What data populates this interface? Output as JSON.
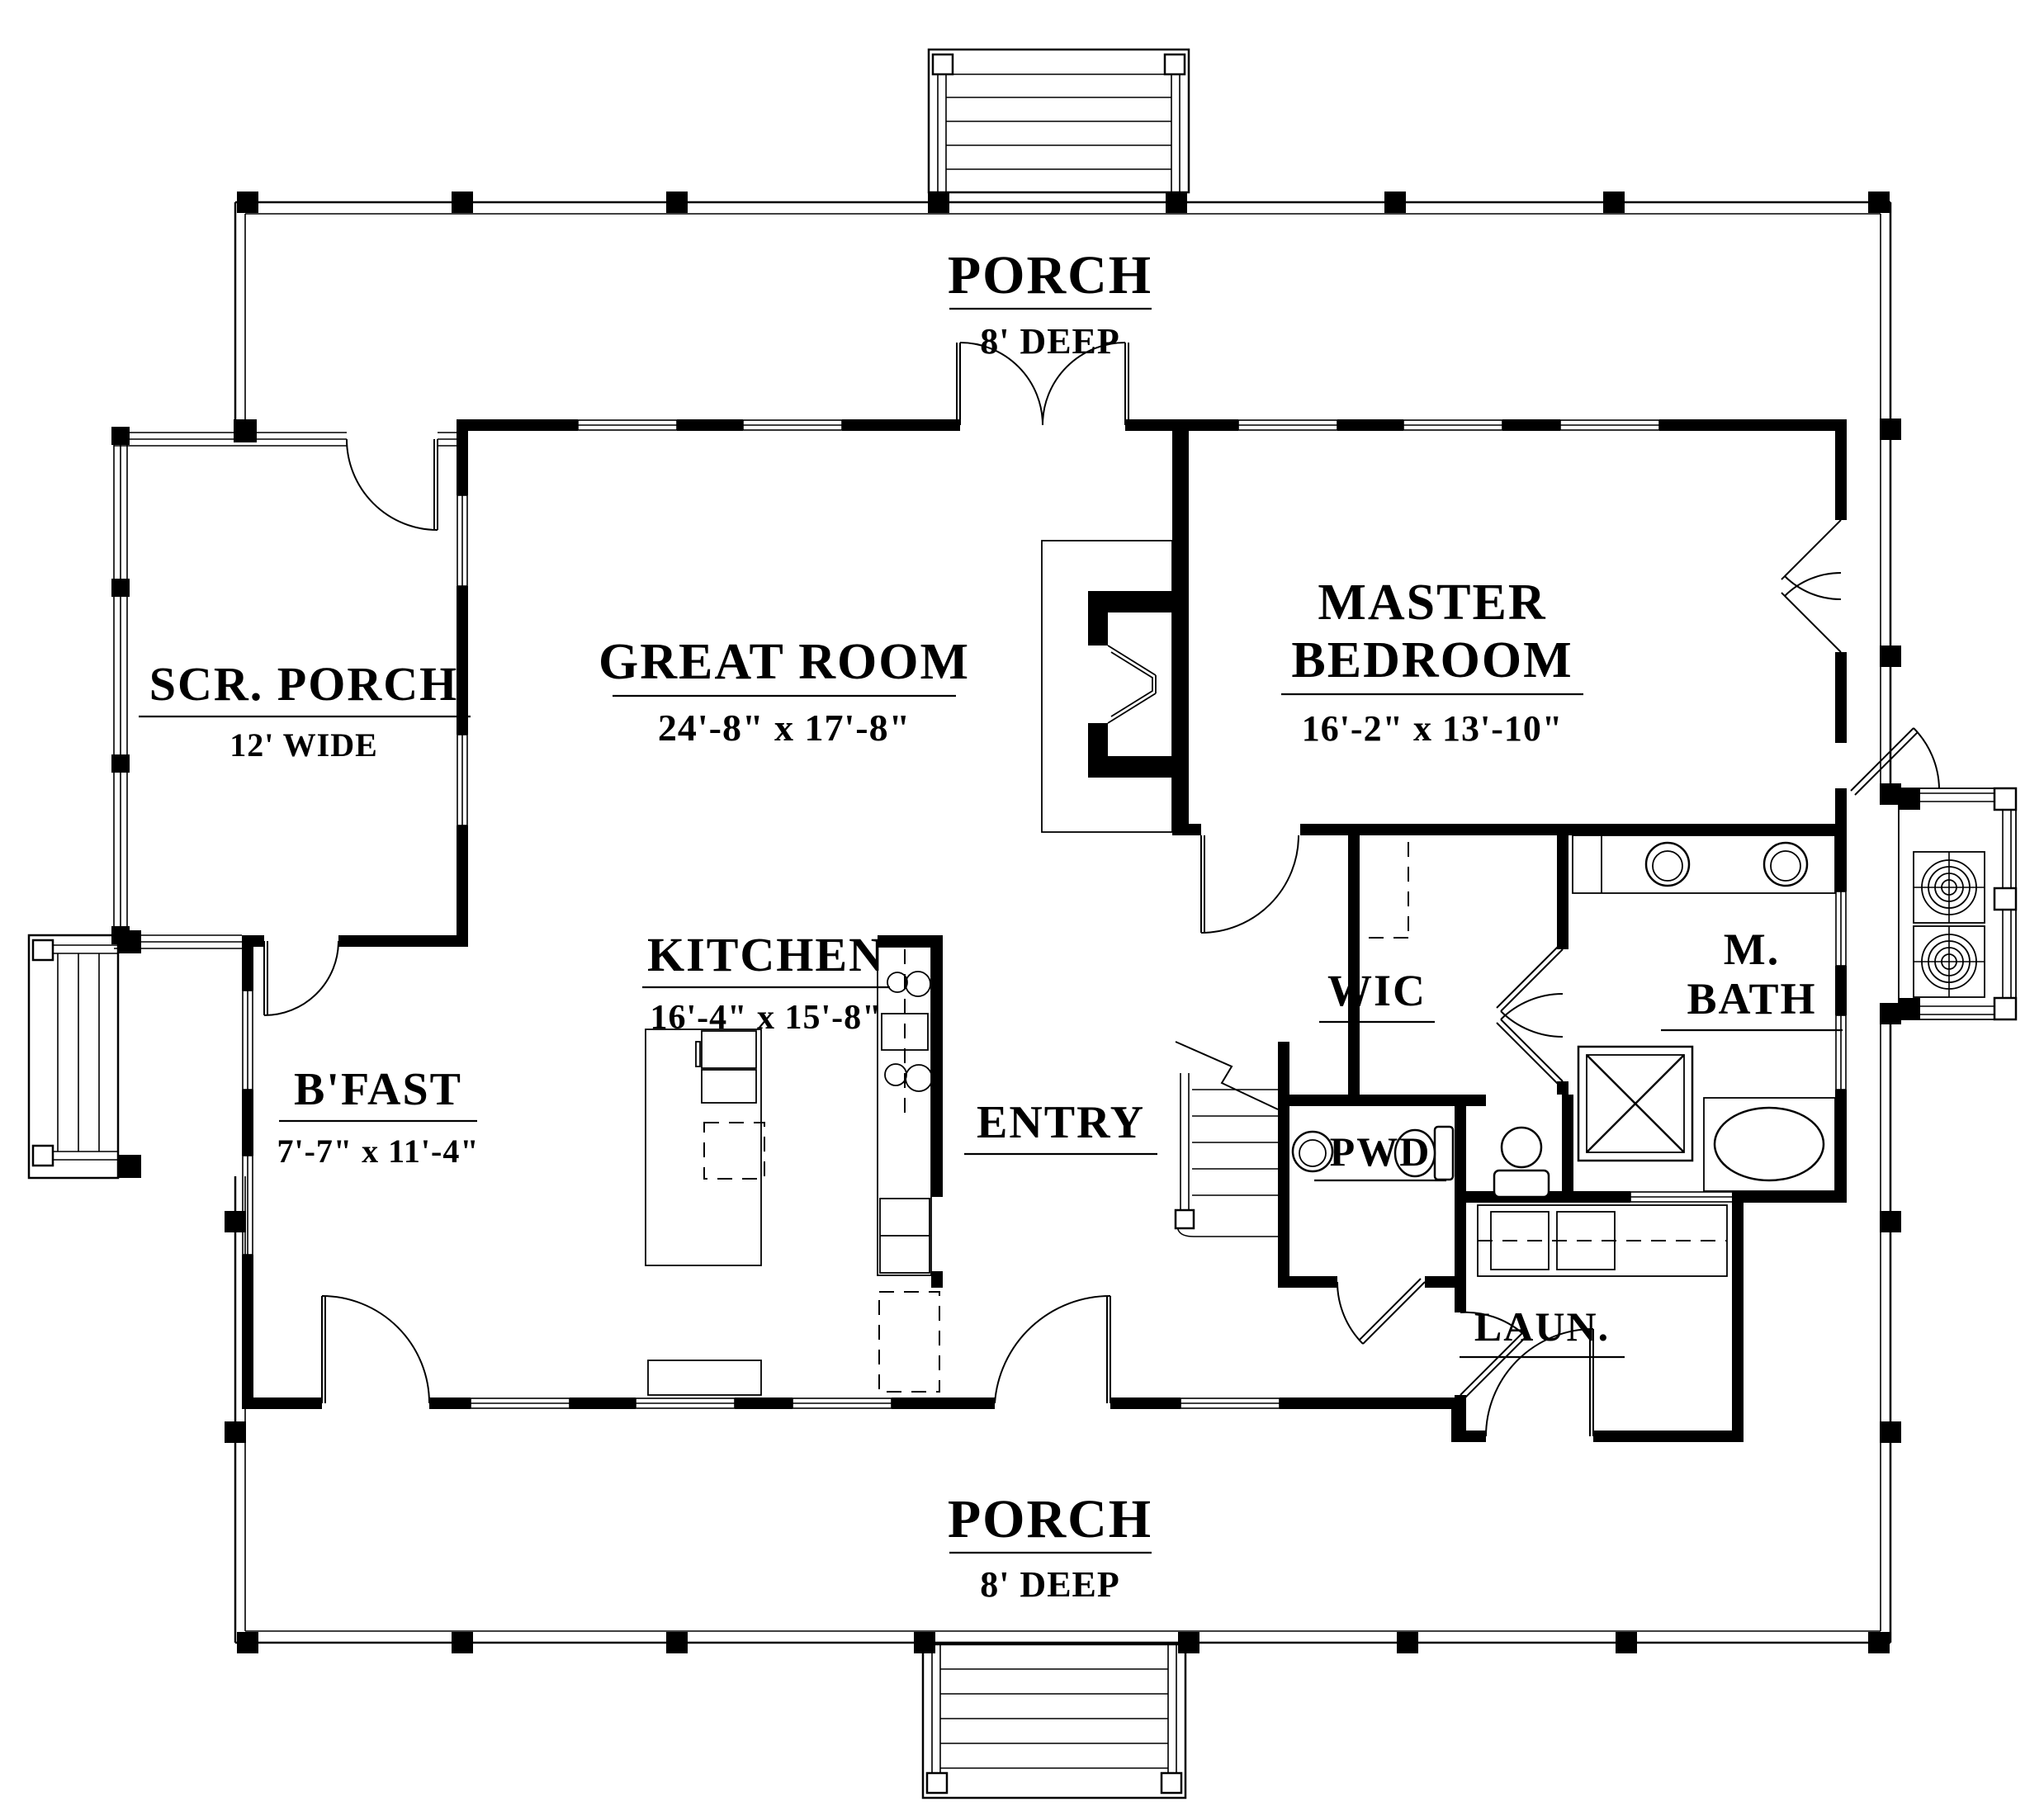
{
  "plan_title": "First Floor Plan",
  "rooms": {
    "porch_top": {
      "name": "PORCH",
      "dim": "8' DEEP"
    },
    "screened_porch": {
      "name": "SCR. PORCH",
      "dim": "12' WIDE"
    },
    "great_room": {
      "name": "GREAT ROOM",
      "dim": "24'-8\" x 17'-8\""
    },
    "master_bedroom": {
      "line1": "MASTER",
      "line2": "BEDROOM",
      "dim": "16'-2\" x 13'-10\""
    },
    "kitchen": {
      "name": "KITCHEN",
      "dim": "16'-4\" x 15'-8\""
    },
    "breakfast": {
      "name": "B'FAST",
      "dim": "7'-7\" x 11'-4\""
    },
    "entry": {
      "name": "ENTRY"
    },
    "wic": {
      "name": "WIC"
    },
    "master_bath": {
      "line1": "M.",
      "line2": "BATH"
    },
    "powder": {
      "name": "PWD"
    },
    "laundry": {
      "name": "LAUN."
    },
    "porch_bottom": {
      "name": "PORCH",
      "dim": "8' DEEP"
    }
  },
  "colors": {
    "ink": "#000000",
    "paper": "#ffffff"
  }
}
